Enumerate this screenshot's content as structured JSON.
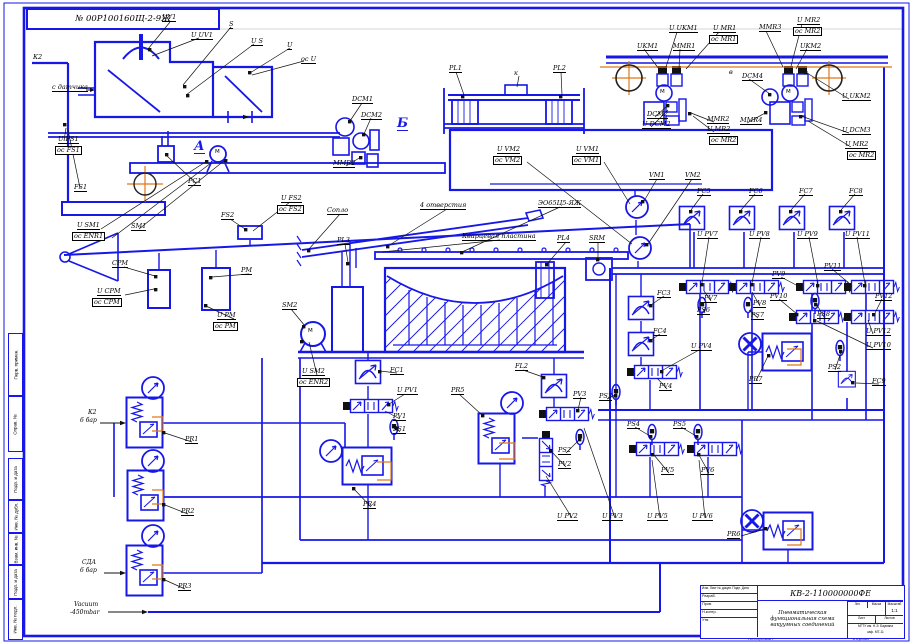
{
  "colors": {
    "line_blue": "#1717e8",
    "accent_orange": "#e07818",
    "leader_black": "#111111"
  },
  "frame": {
    "stamp": "№ 00Р100160Щ-2-9Ж"
  },
  "side": [
    "Перв. примен.",
    "Справ. №",
    "Подп. и дата",
    "Инв. № дубл.",
    "Взам. инв. №",
    "Подп. и дата",
    "Инв. № подл."
  ],
  "title_block": {
    "doc_number": "КВ-2-110000000ФЕ",
    "hdr": "Изм. Лист № докум. Подп. Дата",
    "r1": "Разраб.",
    "r2": "Пров.",
    "r3": "Н.контр.",
    "r4": "Утв.",
    "desc1": "Пневматическая",
    "desc2": "функциональная схема",
    "desc3": "вакуумных соединений",
    "lit": "Лит.",
    "mass": "Масса",
    "scale": "Масштаб",
    "scale_value": "1:1",
    "sheet": "Лист",
    "sheets": "Листов",
    "org1": "МГТУ им. Н.Э. Баумана",
    "org2": "каф. МТ-11"
  },
  "labels": [
    {
      "t": "UV1",
      "x": 162,
      "y": 14
    },
    {
      "t": "U UV1",
      "x": 191,
      "y": 32
    },
    {
      "t": "S",
      "x": 229,
      "y": 21
    },
    {
      "t": "U S",
      "x": 251,
      "y": 38
    },
    {
      "t": "U",
      "x": 287,
      "y": 42
    },
    {
      "t": "ос U",
      "x": 301,
      "y": 56
    },
    {
      "t": "К2",
      "x": 33,
      "y": 54,
      "s": "p"
    },
    {
      "t": "с датчика",
      "x": 52,
      "y": 84
    },
    {
      "t": "U FS1",
      "x": 58,
      "y": 136
    },
    {
      "t": "ос FS1",
      "x": 55,
      "y": 146,
      "s": "b"
    },
    {
      "t": "FS1",
      "x": 74,
      "y": 184
    },
    {
      "t": "А",
      "x": 194,
      "y": 140,
      "s": "sec"
    },
    {
      "t": "PC1",
      "x": 188,
      "y": 178
    },
    {
      "t": "U SM1",
      "x": 77,
      "y": 222
    },
    {
      "t": "ос ENR1",
      "x": 72,
      "y": 232,
      "s": "b"
    },
    {
      "t": "SM1",
      "x": 131,
      "y": 223
    },
    {
      "t": "DCM1",
      "x": 352,
      "y": 96
    },
    {
      "t": "DCM2",
      "x": 361,
      "y": 112
    },
    {
      "t": "MMR2",
      "x": 333,
      "y": 160
    },
    {
      "t": "Б",
      "x": 397,
      "y": 117,
      "s": "sec"
    },
    {
      "t": "PL1",
      "x": 449,
      "y": 65
    },
    {
      "t": "PL2",
      "x": 553,
      "y": 65
    },
    {
      "t": "к",
      "x": 514,
      "y": 70,
      "s": "p"
    },
    {
      "t": "U VM2",
      "x": 497,
      "y": 146
    },
    {
      "t": "ос VM2",
      "x": 493,
      "y": 156,
      "s": "b"
    },
    {
      "t": "U VM1",
      "x": 576,
      "y": 146
    },
    {
      "t": "ос VM1",
      "x": 572,
      "y": 156,
      "s": "b"
    },
    {
      "t": "VM1",
      "x": 649,
      "y": 172
    },
    {
      "t": "VM2",
      "x": 685,
      "y": 172
    },
    {
      "t": "FS2",
      "x": 221,
      "y": 212
    },
    {
      "t": "U FS2",
      "x": 281,
      "y": 195
    },
    {
      "t": "ос FS2",
      "x": 277,
      "y": 205,
      "s": "b"
    },
    {
      "t": "Сопло",
      "x": 327,
      "y": 207
    },
    {
      "t": "4 отверстия",
      "x": 420,
      "y": 202
    },
    {
      "t": "ЭО65Ц5-ЯЖ",
      "x": 538,
      "y": 200
    },
    {
      "t": "Кварцевая пластина",
      "x": 462,
      "y": 233
    },
    {
      "t": "PL4",
      "x": 557,
      "y": 235
    },
    {
      "t": "SRM",
      "x": 589,
      "y": 235
    },
    {
      "t": "CPM",
      "x": 112,
      "y": 260
    },
    {
      "t": "U CPM",
      "x": 97,
      "y": 288
    },
    {
      "t": "ос CPM",
      "x": 92,
      "y": 298,
      "s": "b"
    },
    {
      "t": "PM",
      "x": 241,
      "y": 267
    },
    {
      "t": "U PM",
      "x": 217,
      "y": 312
    },
    {
      "t": "ос PM",
      "x": 213,
      "y": 322,
      "s": "b"
    },
    {
      "t": "SM2",
      "x": 282,
      "y": 302
    },
    {
      "t": "U SM2",
      "x": 302,
      "y": 368
    },
    {
      "t": "ос ENR2",
      "x": 297,
      "y": 378,
      "s": "b"
    },
    {
      "t": "PL3",
      "x": 337,
      "y": 237
    },
    {
      "t": "FC1",
      "x": 390,
      "y": 367
    },
    {
      "t": "U PV1",
      "x": 397,
      "y": 387
    },
    {
      "t": "PV1",
      "x": 393,
      "y": 413
    },
    {
      "t": "PS1",
      "x": 393,
      "y": 426
    },
    {
      "t": "PR4",
      "x": 363,
      "y": 501
    },
    {
      "t": "PR5",
      "x": 451,
      "y": 387
    },
    {
      "t": "FL2",
      "x": 515,
      "y": 363
    },
    {
      "t": "PV3",
      "x": 573,
      "y": 391
    },
    {
      "t": "PS2",
      "x": 558,
      "y": 447
    },
    {
      "t": "PV2",
      "x": 558,
      "y": 461
    },
    {
      "t": "PS3",
      "x": 599,
      "y": 393
    },
    {
      "t": "FC3",
      "x": 657,
      "y": 290
    },
    {
      "t": "FC4",
      "x": 653,
      "y": 328
    },
    {
      "t": "U PV4",
      "x": 691,
      "y": 343
    },
    {
      "t": "PV4",
      "x": 659,
      "y": 383
    },
    {
      "t": "PS4",
      "x": 627,
      "y": 421
    },
    {
      "t": "PS5",
      "x": 673,
      "y": 421
    },
    {
      "t": "PV5",
      "x": 661,
      "y": 467
    },
    {
      "t": "PV6",
      "x": 701,
      "y": 467
    },
    {
      "t": "U PV2",
      "x": 557,
      "y": 513
    },
    {
      "t": "U PV3",
      "x": 602,
      "y": 513
    },
    {
      "t": "U PV5",
      "x": 647,
      "y": 513
    },
    {
      "t": "U PV6",
      "x": 692,
      "y": 513
    },
    {
      "t": "PR6",
      "x": 727,
      "y": 531
    },
    {
      "t": "FC5",
      "x": 697,
      "y": 188
    },
    {
      "t": "FC6",
      "x": 749,
      "y": 188
    },
    {
      "t": "FC7",
      "x": 799,
      "y": 188
    },
    {
      "t": "FC8",
      "x": 849,
      "y": 188
    },
    {
      "t": "U PV7",
      "x": 697,
      "y": 231
    },
    {
      "t": "U PV8",
      "x": 749,
      "y": 231
    },
    {
      "t": "U PV9",
      "x": 797,
      "y": 231
    },
    {
      "t": "U PV11",
      "x": 845,
      "y": 231
    },
    {
      "t": "PV7",
      "x": 704,
      "y": 295
    },
    {
      "t": "PS6",
      "x": 697,
      "y": 307
    },
    {
      "t": "PV8",
      "x": 753,
      "y": 300
    },
    {
      "t": "PS7",
      "x": 751,
      "y": 312
    },
    {
      "t": "PV9",
      "x": 772,
      "y": 271
    },
    {
      "t": "PV10",
      "x": 770,
      "y": 293
    },
    {
      "t": "PS8",
      "x": 817,
      "y": 311
    },
    {
      "t": "PV11",
      "x": 824,
      "y": 263
    },
    {
      "t": "PV12",
      "x": 875,
      "y": 293
    },
    {
      "t": "U PV12",
      "x": 866,
      "y": 328
    },
    {
      "t": "U PV10",
      "x": 866,
      "y": 342
    },
    {
      "t": "PR7",
      "x": 749,
      "y": 376
    },
    {
      "t": "PS2",
      "x": 828,
      "y": 364
    },
    {
      "t": "FC9",
      "x": 872,
      "y": 378
    },
    {
      "t": "PR1",
      "x": 185,
      "y": 436
    },
    {
      "t": "PR2",
      "x": 181,
      "y": 508
    },
    {
      "t": "PR3",
      "x": 178,
      "y": 583
    },
    {
      "t": "К2",
      "x": 88,
      "y": 410,
      "s": "io"
    },
    {
      "t": "6 бар",
      "x": 80,
      "y": 418,
      "s": "io"
    },
    {
      "t": "СДА",
      "x": 82,
      "y": 560,
      "s": "io"
    },
    {
      "t": "6 бар",
      "x": 80,
      "y": 568,
      "s": "io"
    },
    {
      "t": "Vacuum",
      "x": 74,
      "y": 602,
      "s": "io"
    },
    {
      "t": "-450mbar",
      "x": 70,
      "y": 610,
      "s": "io"
    },
    {
      "t": "UKM1",
      "x": 637,
      "y": 43
    },
    {
      "t": "U UKM1",
      "x": 669,
      "y": 25
    },
    {
      "t": "MMR1",
      "x": 673,
      "y": 43
    },
    {
      "t": "U MR1",
      "x": 713,
      "y": 25
    },
    {
      "t": "ос MR1",
      "x": 709,
      "y": 35,
      "s": "b"
    },
    {
      "t": "MMR3",
      "x": 759,
      "y": 24
    },
    {
      "t": "U MR2",
      "x": 797,
      "y": 17
    },
    {
      "t": "ос MR2",
      "x": 793,
      "y": 27,
      "s": "b"
    },
    {
      "t": "UKM2",
      "x": 800,
      "y": 43
    },
    {
      "t": "DCM2",
      "x": 647,
      "y": 111
    },
    {
      "t": "U DCM2",
      "x": 642,
      "y": 121
    },
    {
      "t": "MMR2",
      "x": 707,
      "y": 116
    },
    {
      "t": "U MR2",
      "x": 707,
      "y": 126
    },
    {
      "t": "ос MR2",
      "x": 709,
      "y": 136,
      "s": "b"
    },
    {
      "t": "DCM4",
      "x": 742,
      "y": 73
    },
    {
      "t": "MMR4",
      "x": 740,
      "y": 117
    },
    {
      "t": "в",
      "x": 729,
      "y": 69,
      "s": "p"
    },
    {
      "t": "U UKM2",
      "x": 842,
      "y": 93
    },
    {
      "t": "U DCM3",
      "x": 842,
      "y": 127
    },
    {
      "t": "U MR2",
      "x": 845,
      "y": 141
    },
    {
      "t": "ос MR2",
      "x": 847,
      "y": 151,
      "s": "b"
    },
    {
      "t": "М",
      "x": 215,
      "y": 150,
      "s": "m"
    },
    {
      "t": "М",
      "x": 308,
      "y": 329,
      "s": "m"
    },
    {
      "t": "М",
      "x": 660,
      "y": 90,
      "s": "m"
    },
    {
      "t": "М",
      "x": 786,
      "y": 90,
      "s": "m"
    },
    {
      "t": "Копировал",
      "x": 748,
      "y": 637,
      "s": "t"
    },
    {
      "t": "Формат",
      "x": 852,
      "y": 637,
      "s": "t"
    }
  ]
}
